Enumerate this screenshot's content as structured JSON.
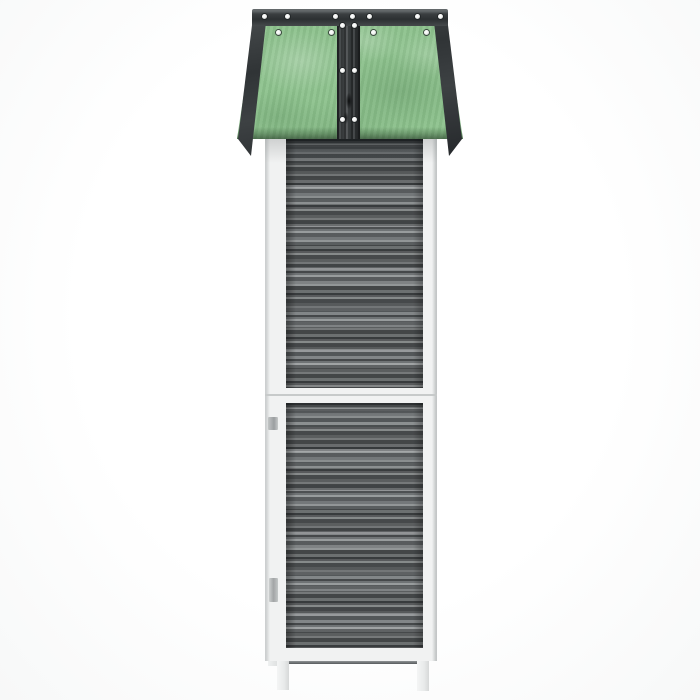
{
  "image": {
    "type": "product-photo",
    "subject": "Tall narrow wooden garden shed seen from the side: green felt apex roof with dark grey trim and white screws, grey wood-grain side panels in two stacked sections, white frame rails and two white feet",
    "background_color": "#ffffff",
    "contains_text": false
  },
  "palette": {
    "bg": "#ffffff",
    "felt": "#8dc28d",
    "felt-dark": "#6fae74",
    "trim": "#33373a",
    "strip": "#3c4042",
    "screw": "#f3f4f3",
    "panel": "#74787a",
    "panel-dark": "#474b4d",
    "panel-light": "#9da1a2",
    "frame": "#f1f2f2",
    "frame-shadow": "#d6d8d8",
    "ground-line": "#565a5c"
  },
  "roof": {
    "shape": "trapezoid widening downward (apex roof viewed end-on)",
    "felt_color": "#8dc28d",
    "trim_color": "#33373a",
    "screws": {
      "color": "#f3f4f3",
      "points": [
        [
          25,
          6
        ],
        [
          48,
          6
        ],
        [
          96,
          6
        ],
        [
          113,
          6
        ],
        [
          130,
          6
        ],
        [
          178,
          6
        ],
        [
          201,
          6
        ],
        [
          39,
          22
        ],
        [
          92,
          22
        ],
        [
          134,
          22
        ],
        [
          187,
          22
        ],
        [
          103,
          15
        ],
        [
          115,
          15
        ],
        [
          103,
          60
        ],
        [
          115,
          60
        ],
        [
          103,
          109
        ],
        [
          115,
          109
        ]
      ]
    }
  },
  "body": {
    "frame_color": "#f1f2f2",
    "panel_color": "#74787a",
    "panel_streak_dark": "#474b4d",
    "panel_streak_light": "#9da1a2",
    "sections": [
      "upper side panel",
      "lower side panel"
    ],
    "hinges_visible_left_edge": 2,
    "hinge_color": "#a8abac"
  },
  "base": {
    "legs": 2,
    "leg_color": "#eceeee",
    "shadow_line_color": "#565a5c"
  }
}
